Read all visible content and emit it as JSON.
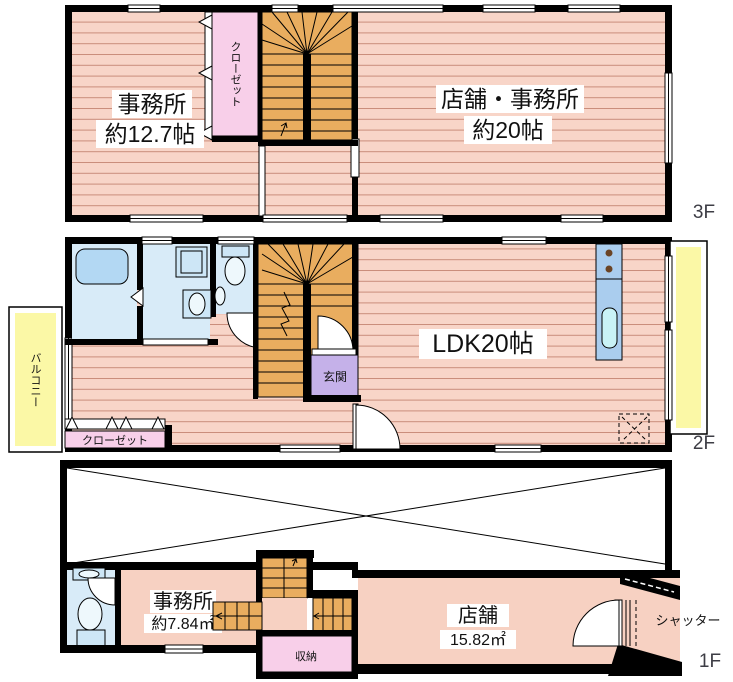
{
  "palette": {
    "wall": "#000000",
    "floor_pink": "#f8d5c8",
    "floor_line": "#c98d7b",
    "plain_pink": "#f7d1c2",
    "stair_orange": "#e9ad5f",
    "closet_pink": "#f8cfe9",
    "entrance_purple": "#c5b1e9",
    "balcony_yellow": "#fbf8a6",
    "wet_blue": "#d8ebf8",
    "fixture_blue": "#b3d8f3",
    "kitchen_blue": "#aacdee",
    "sink_cyan": "#c9f2f6",
    "floor_label_gray": "#3d3d45"
  },
  "floor3": {
    "floor_label": "3F",
    "office": {
      "name": "事務所",
      "size": "約12.7帖"
    },
    "shop_office": {
      "name": "店舗・事務所",
      "size": "約20帖"
    },
    "closet": "クローゼット"
  },
  "floor2": {
    "floor_label": "2F",
    "ldk": "LDK20帖",
    "entrance": "玄関",
    "closet": "クローゼット",
    "balcony": "バルコニー"
  },
  "floor1": {
    "floor_label": "1F",
    "office": {
      "name": "事務所",
      "size": "約7.84㎡"
    },
    "shop": {
      "name": "店舗",
      "size": "15.82㎡"
    },
    "storage": "収納",
    "shutter": "シャッター"
  }
}
